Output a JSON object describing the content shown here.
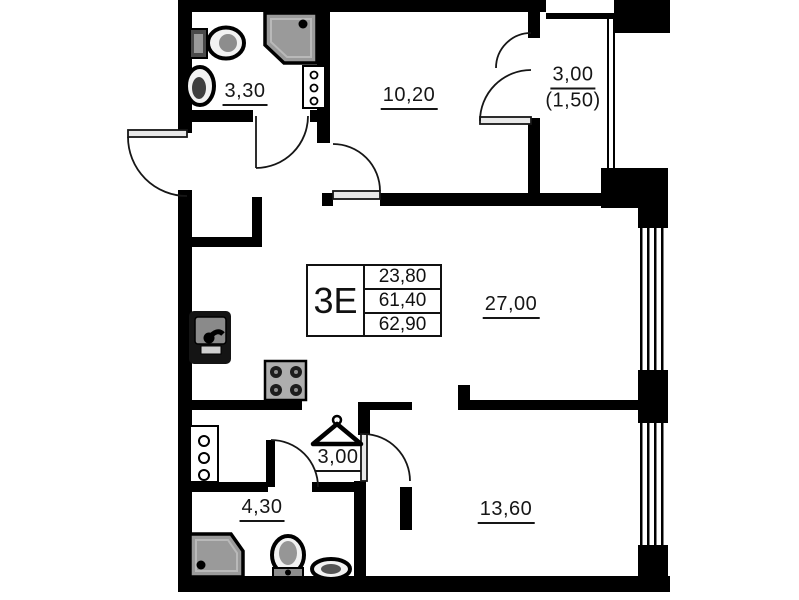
{
  "floorplan": {
    "unit_stamp": {
      "type": "3Е",
      "values": [
        "23,80",
        "61,40",
        "62,90"
      ]
    },
    "labels": {
      "bathroom_top": "3,30",
      "bedroom": "10,20",
      "balcony": "3,00",
      "balcony_reduced": "(1,50)",
      "living_kitchen": "27,00",
      "wardrobe": "3,00",
      "bathroom_bottom": "4,30",
      "room_bottom": "13,60"
    },
    "colors": {
      "wall": "#000000",
      "fixture_gray": "#9a9a9a",
      "line": "#161616"
    }
  }
}
